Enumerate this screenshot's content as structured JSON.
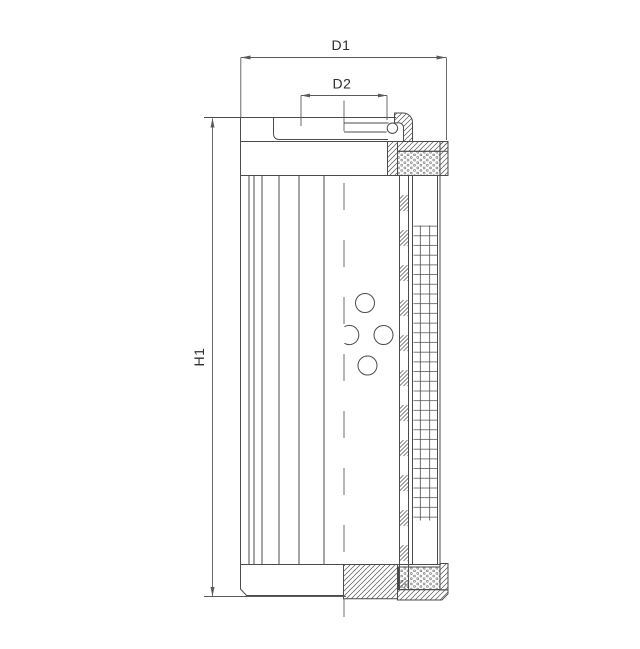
{
  "drawing": {
    "dimensions": {
      "d1": "D1",
      "d2": "D2",
      "h1": "H1"
    },
    "colors": {
      "background": "#ffffff",
      "part_line": "#4b4b4b",
      "dimension_line": "#5a5a5a",
      "label_text": "#2e2e2e"
    }
  }
}
